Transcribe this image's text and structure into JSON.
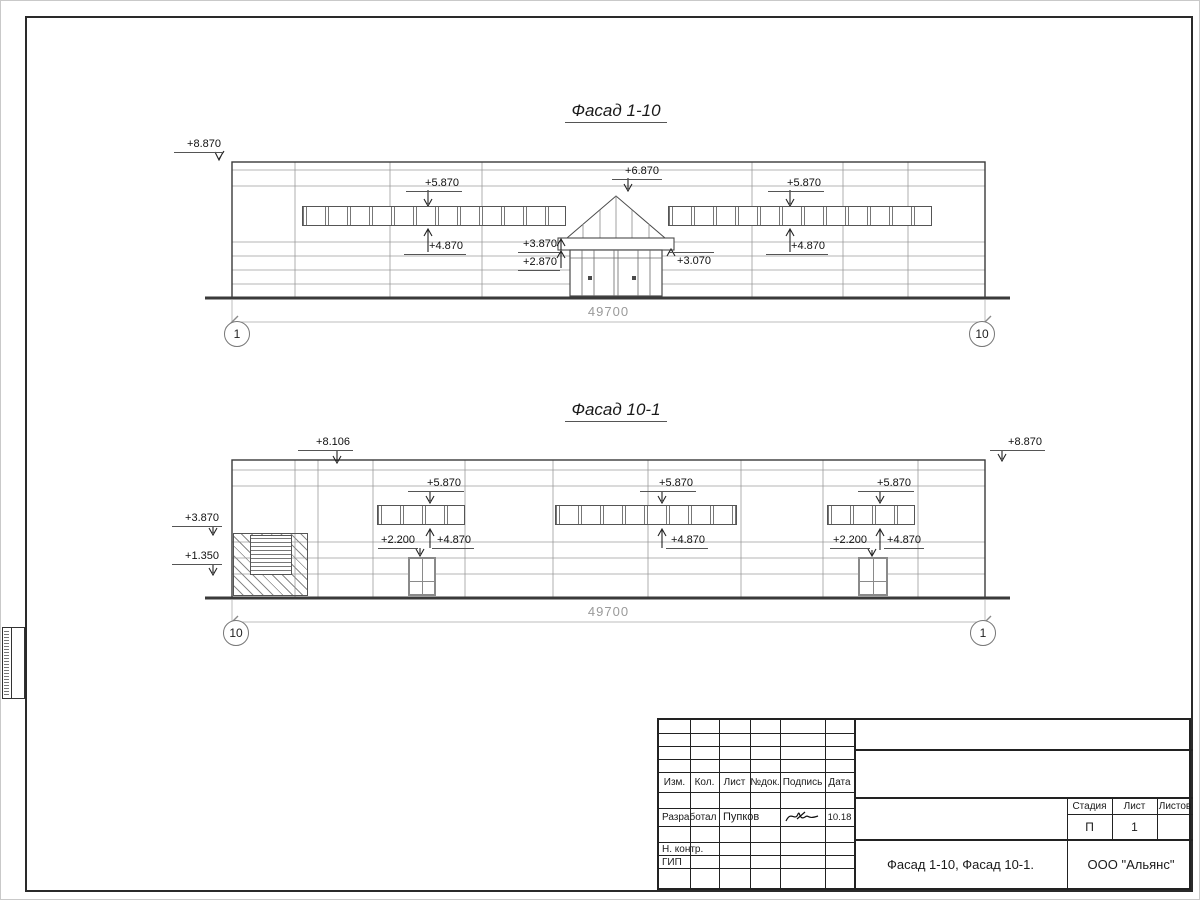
{
  "facade1": {
    "title": "Фасад 1-10",
    "dim": "49700",
    "axis_left": "1",
    "axis_right": "10",
    "marks": {
      "roof": "+8.870",
      "gable": "+6.870",
      "band_left_top": "+5.870",
      "band_left_bottom": "+4.870",
      "band_right_top": "+5.870",
      "band_right_bottom": "+4.870",
      "canopy_top": "+3.870",
      "canopy_bottom": "+2.870",
      "canopy_right": "+3.070"
    }
  },
  "facade2": {
    "title": "Фасад 10-1",
    "dim": "49700",
    "axis_left": "10",
    "axis_right": "1",
    "marks": {
      "parapet_left": "+8.106",
      "parapet_right": "+8.870",
      "wall_left_upper": "+3.870",
      "wall_left_lower": "+1.350",
      "band_a_top": "+5.870",
      "band_a_bottom": "+4.870",
      "door_a": "+2.200",
      "band_b_top": "+5.870",
      "band_b_bottom": "+4.870",
      "band_c_top": "+5.870",
      "band_c_bottom": "+4.870",
      "door_c": "+2.200"
    }
  },
  "titleblock": {
    "cols": {
      "izm": "Изм.",
      "kol": "Кол.",
      "list": "Лист",
      "ndok": "№док.",
      "podpis": "Подпись",
      "data": "Дата"
    },
    "rows": {
      "developer_role": "Разработал",
      "developer_name": "Пупков",
      "date": "10.18",
      "ncontr": "Н. контр.",
      "gip": "ГИП"
    },
    "stage_label": "Стадия",
    "sheet_label": "Лист",
    "sheets_label": "Листов",
    "stage": "П",
    "sheet_no": "1",
    "doc_title": "Фасад 1-10, Фасад 10-1.",
    "company": "ООО \"Альянс\""
  }
}
